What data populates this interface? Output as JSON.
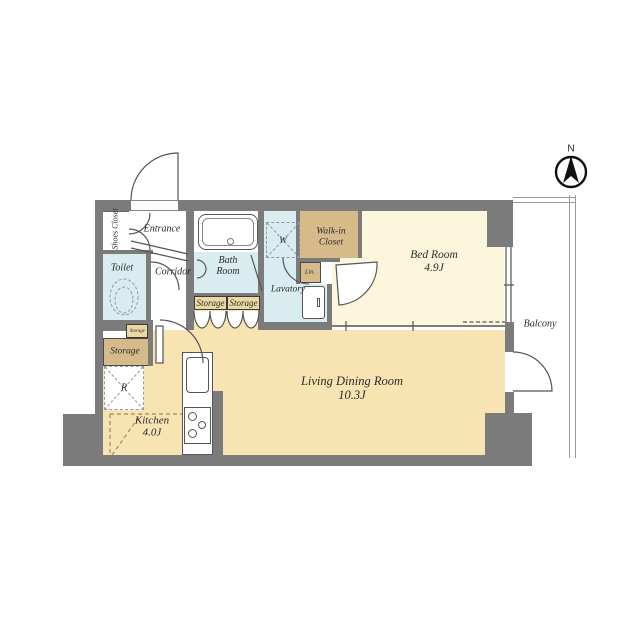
{
  "compass": {
    "north_label": "N"
  },
  "rooms": {
    "entrance": {
      "label": "Entrance"
    },
    "shoes_closet": {
      "label": "Shoes Closet"
    },
    "toilet": {
      "label": "Toilet"
    },
    "corridor": {
      "label": "Corridor"
    },
    "bath_room": {
      "label": "Bath Room"
    },
    "lavatory": {
      "label": "Lavatory"
    },
    "walk_in_closet": {
      "label": "Walk-in Closet"
    },
    "linen": {
      "label": "Lin."
    },
    "bed_room": {
      "label": "Bed Room",
      "size": "4.9J"
    },
    "living_dining": {
      "label": "Living Dining Room",
      "size": "10.3J"
    },
    "kitchen": {
      "label": "Kitchen",
      "size": "4.0J"
    },
    "balcony": {
      "label": "Balcony"
    },
    "storage_hall_1": {
      "label": "Storage"
    },
    "storage_hall_2": {
      "label": "Storage"
    },
    "storage_small": {
      "label": "Storage"
    },
    "storage_left": {
      "label": "Storage"
    },
    "washer": {
      "label": "W"
    },
    "refrigerator": {
      "label": "R"
    }
  },
  "colors": {
    "wall": "#7b7b7b",
    "floor_living": "#f8e3b3",
    "floor_bedroom": "#fcf6dd",
    "floor_closet": "#d6ba8a",
    "floor_wet": "#d9edf0",
    "label_box": "#ecd9a2",
    "text": "#2b2b2b"
  }
}
